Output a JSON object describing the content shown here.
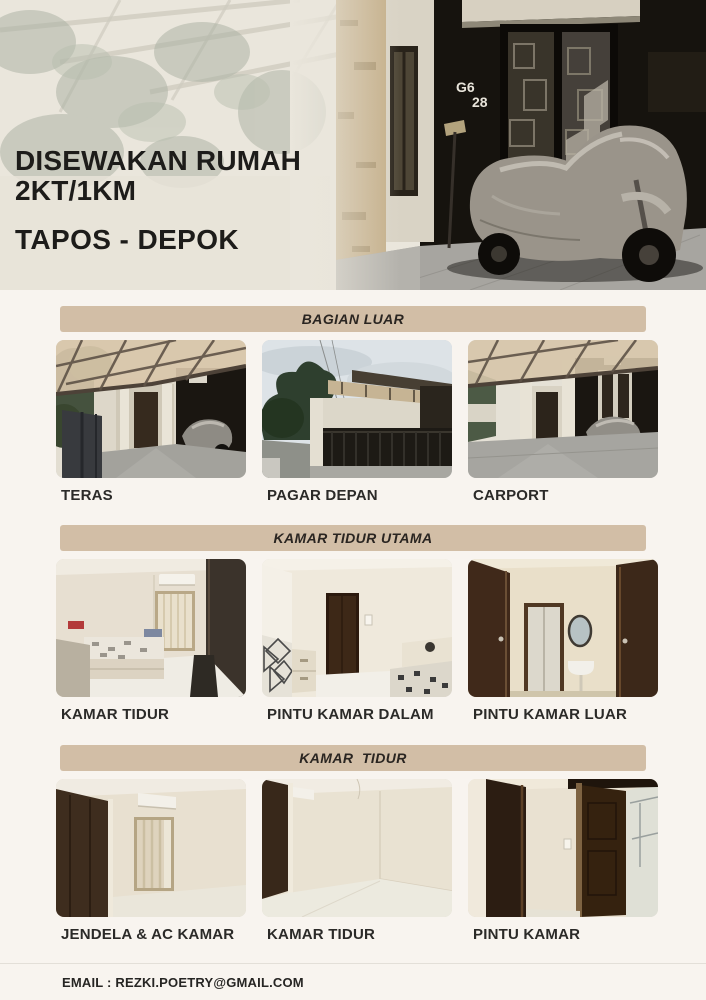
{
  "hero": {
    "title_line1": "DISEWAKAN RUMAH",
    "title_line2": "2KT/1KM",
    "subtitle": "TAPOS - DEPOK",
    "house_number_top": "G6",
    "house_number_bottom": "28"
  },
  "sections": [
    {
      "header": "BAGIAN LUAR",
      "photos": [
        {
          "label": "TERAS"
        },
        {
          "label": "PAGAR DEPAN"
        },
        {
          "label": "CARPORT"
        }
      ]
    },
    {
      "header": "KAMAR TIDUR UTAMA",
      "photos": [
        {
          "label": "KAMAR TIDUR"
        },
        {
          "label": "PINTU KAMAR DALAM"
        },
        {
          "label": "PINTU KAMAR LUAR"
        }
      ]
    },
    {
      "header": "KAMAR  TIDUR",
      "photos": [
        {
          "label": "JENDELA & AC KAMAR"
        },
        {
          "label": "KAMAR TIDUR"
        },
        {
          "label": "PINTU KAMAR"
        }
      ]
    }
  ],
  "footer": {
    "email_label": "EMAIL : REZKI.POETRY@GMAIL.COM"
  },
  "colors": {
    "banner_bg": "#d2bea6",
    "page_bg": "#f8f4ef",
    "heading_text": "#1d1c1a",
    "label_text": "#2b2a28"
  }
}
